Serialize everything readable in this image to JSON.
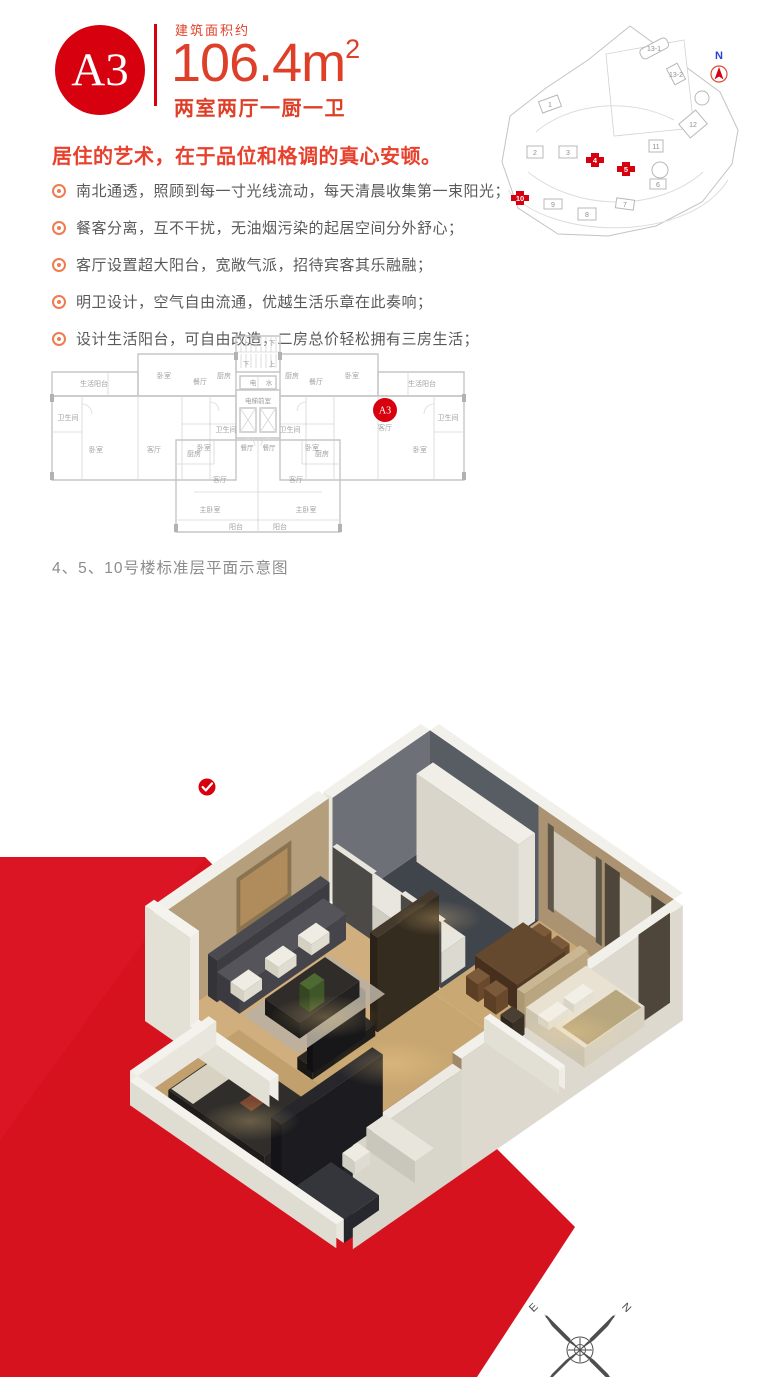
{
  "header": {
    "unit_badge": "A3",
    "area_label": "建筑面积约",
    "area_value": "106.4m",
    "area_sup": "2",
    "layout": "两室两厅一厨一卫"
  },
  "intro": {
    "headline": "居住的艺术，在于品位和格调的真心安顿。",
    "bullets": [
      "南北通透，照顾到每一寸光线流动，每天清晨收集第一束阳光；",
      "餐客分离，互不干扰，无油烟污染的起居空间分外舒心；",
      "客厅设置超大阳台，宽敞气派，招待宾客其乐融融；",
      "明卫设计，空气自由流通，优越生活乐章在此奏响；",
      "设计生活阳台，可自由改造，二房总价轻松拥有三房生活；"
    ]
  },
  "siteplan": {
    "north_label": "N",
    "buildings": [
      {
        "label": "1"
      },
      {
        "label": "2"
      },
      {
        "label": "3"
      },
      {
        "label": "6"
      },
      {
        "label": "7"
      },
      {
        "label": "8"
      },
      {
        "label": "9"
      },
      {
        "label": "11"
      },
      {
        "label": "12"
      },
      {
        "label": "13-1"
      },
      {
        "label": "13-2"
      }
    ],
    "highlighted": [
      {
        "label": "4"
      },
      {
        "label": "5"
      },
      {
        "label": "10"
      }
    ]
  },
  "floorplan": {
    "badge": "A3",
    "caption": "4、5、10号楼标准层平面示意图",
    "labels": [
      "生活阳台",
      "卧室",
      "餐厅",
      "厨房",
      "卫生间",
      "卧室",
      "客厅",
      "卧室",
      "卫生间",
      "上",
      "下",
      "下",
      "上",
      "电",
      "水",
      "电梯前室",
      "餐厅",
      "餐厅",
      "厨房",
      "客厅",
      "主卧室",
      "阳台",
      "阳台",
      "主卧室",
      "客厅",
      "厨房",
      "厨房",
      "餐厅",
      "卧室",
      "生活阳台",
      "卫生间",
      "卧室",
      "客厅",
      "卧室",
      "卫生间"
    ]
  },
  "compass": {
    "n": "N",
    "e": "E",
    "s": "S",
    "w": "W"
  },
  "colors": {
    "brand_red": "#d6000f",
    "backdrop_red": "#d7121f",
    "accent_orange": "#ee7c50",
    "text_red": "#dd3f28",
    "text_gray": "#595959"
  },
  "apartment": {
    "items": [
      {
        "k": "f",
        "u": 5,
        "v": 5,
        "du": 145,
        "dv": 130,
        "c": "#40444b"
      },
      {
        "k": "f",
        "u": 150,
        "v": 5,
        "du": 80,
        "dv": 140,
        "c": "#c9a873"
      },
      {
        "k": "f",
        "u": 230,
        "v": 5,
        "du": 100,
        "dv": 145,
        "c": "#cdab77"
      },
      {
        "k": "f",
        "u": 0,
        "v": 135,
        "du": 150,
        "dv": 215,
        "c": "#d0ae7d"
      },
      {
        "k": "f",
        "u": 150,
        "v": 145,
        "du": 80,
        "dv": 165,
        "c": "#c8a671"
      },
      {
        "k": "f",
        "u": 55,
        "v": 310,
        "du": 185,
        "dv": 135,
        "c": "#c2a06e"
      },
      {
        "k": "f",
        "u": 240,
        "v": 300,
        "du": 90,
        "dv": 145,
        "c": "#1a1b1f"
      },
      {
        "k": "w",
        "ax": "u",
        "c": 5,
        "a1": 5,
        "a2": 150,
        "h": 115,
        "t": -12,
        "face": "#585c63",
        "outer": null,
        "top": "#f2f0ea"
      },
      {
        "k": "w",
        "ax": "u",
        "c": 5,
        "a1": 150,
        "a2": 330,
        "h": 115,
        "t": -12,
        "face": "#ab9371",
        "outer": null,
        "top": "#f2f0ea"
      },
      {
        "k": "c",
        "pts": [
          [
            168,
            5,
            100
          ],
          [
            228,
            5,
            100
          ],
          [
            228,
            5,
            22
          ],
          [
            168,
            5,
            22
          ]
        ],
        "c": "#cfc8b8"
      },
      {
        "k": "c",
        "pts": [
          [
            162,
            5,
            104
          ],
          [
            170,
            5,
            104
          ],
          [
            170,
            5,
            18
          ],
          [
            162,
            5,
            18
          ]
        ],
        "c": "#5d5649"
      },
      {
        "k": "c",
        "pts": [
          [
            226,
            5,
            104
          ],
          [
            234,
            5,
            104
          ],
          [
            234,
            5,
            18
          ],
          [
            226,
            5,
            18
          ]
        ],
        "c": "#5d5649"
      },
      {
        "k": "c",
        "pts": [
          [
            238,
            5,
            104
          ],
          [
            258,
            5,
            104
          ],
          [
            258,
            5,
            14
          ],
          [
            238,
            5,
            14
          ]
        ],
        "c": "#4e463a"
      },
      {
        "k": "c",
        "pts": [
          [
            258,
            5,
            100
          ],
          [
            300,
            5,
            100
          ],
          [
            300,
            5,
            18
          ],
          [
            258,
            5,
            18
          ]
        ],
        "c": "#d5cfbf"
      },
      {
        "k": "c",
        "pts": [
          [
            300,
            5,
            104
          ],
          [
            324,
            5,
            104
          ],
          [
            324,
            5,
            14
          ],
          [
            300,
            5,
            14
          ]
        ],
        "c": "#4e463a"
      },
      {
        "k": "w",
        "ax": "v",
        "c": 5,
        "a1": 5,
        "a2": 135,
        "h": 115,
        "t": -12,
        "face": "#6d7077",
        "outer": "#e9e6dd",
        "top": "#f2f0ea"
      },
      {
        "k": "w",
        "ax": "v",
        "c": 0,
        "a1": 135,
        "a2": 350,
        "h": 112,
        "t": -14,
        "face": "#b59e7b",
        "outer": "#eae7de",
        "top": "#f2f0ea"
      },
      {
        "k": "c",
        "pts": [
          [
            0,
            185,
            96
          ],
          [
            0,
            258,
            96
          ],
          [
            0,
            258,
            40
          ],
          [
            0,
            185,
            40
          ]
        ],
        "c": "#8a7350"
      },
      {
        "k": "c",
        "pts": [
          [
            0,
            190,
            91
          ],
          [
            0,
            253,
            91
          ],
          [
            0,
            253,
            45
          ],
          [
            0,
            190,
            45
          ]
        ],
        "c": "#b08c5c"
      },
      {
        "k": "w",
        "ax": "v",
        "c": 330,
        "a1": 5,
        "a2": 300,
        "h": 115,
        "t": 12,
        "face": "#a08968",
        "outer": "#ddd9cf",
        "top": "#f2f0ea"
      },
      {
        "k": "c",
        "pts": [
          [
            330,
            10,
            104
          ],
          [
            330,
            52,
            104
          ],
          [
            330,
            52,
            14
          ],
          [
            330,
            10,
            14
          ]
        ],
        "c": "#4e463a"
      },
      {
        "k": "w",
        "ax": "v",
        "c": 330,
        "a1": 300,
        "a2": 445,
        "h": 104,
        "t": 12,
        "face": "#25272c",
        "outer": "#d8d5cb",
        "top": "#eceae3"
      },
      {
        "k": "b",
        "u": 12,
        "v": 8,
        "du": 136,
        "dv": 22,
        "h": 88,
        "ct": "#f0eee7",
        "cu": "#e4e1d8",
        "cv": "#d9d5ca"
      },
      {
        "k": "b",
        "u": 15,
        "v": 98,
        "du": 130,
        "dv": 32,
        "h": 30,
        "ct": "#e9e6df",
        "cu": "#dcd9d0",
        "cv": "#cfccc2"
      },
      {
        "k": "w",
        "ax": "u",
        "c": 135,
        "a1": 5,
        "a2": 58,
        "h": 66,
        "t": -6,
        "face": "#4b4a47",
        "outer": null,
        "top": "#e8e5dd"
      },
      {
        "k": "w",
        "ax": "u",
        "c": 135,
        "a1": 96,
        "a2": 150,
        "h": 66,
        "t": -6,
        "face": "#4b4a47",
        "outer": null,
        "top": "#e8e5dd"
      },
      {
        "k": "b",
        "u": 172,
        "v": 26,
        "du": 16,
        "dv": 16,
        "h": 20,
        "ct": "#7a5a3b",
        "cu": "#68492c",
        "cv": "#5c3f24"
      },
      {
        "k": "b",
        "u": 196,
        "v": 26,
        "du": 16,
        "dv": 16,
        "h": 20,
        "ct": "#7a5a3b",
        "cu": "#68492c",
        "cv": "#5c3f24"
      },
      {
        "k": "b",
        "u": 166,
        "v": 42,
        "du": 56,
        "dv": 64,
        "h": 26,
        "ct": "#64492f",
        "cu": "#523a24",
        "cv": "#46301d"
      },
      {
        "k": "b",
        "u": 172,
        "v": 108,
        "du": 16,
        "dv": 16,
        "h": 18,
        "ct": "#7a5a3b",
        "cu": "#68492c",
        "cv": "#5c3f24"
      },
      {
        "k": "b",
        "u": 196,
        "v": 108,
        "du": 16,
        "dv": 16,
        "h": 18,
        "ct": "#7a5a3b",
        "cu": "#68492c",
        "cv": "#5c3f24"
      },
      {
        "k": "b",
        "u": 234,
        "v": 34,
        "du": 10,
        "dv": 84,
        "h": 34,
        "ct": "#c9b692",
        "cu": "#b9a57f",
        "cv": "#ac9873"
      },
      {
        "k": "b",
        "u": 244,
        "v": 36,
        "du": 78,
        "dv": 80,
        "h": 20,
        "ct": "#e9e2d2",
        "cu": "#d9d1bf",
        "cv": "#cdc4b0"
      },
      {
        "k": "c",
        "pts": [
          [
            288,
            40,
            21
          ],
          [
            322,
            40,
            21
          ],
          [
            322,
            112,
            21
          ],
          [
            288,
            112,
            21
          ]
        ],
        "c": "#b8a67e"
      },
      {
        "k": "b",
        "u": 248,
        "v": 44,
        "du": 14,
        "dv": 26,
        "h": 8,
        "ct": "#f2efe6",
        "cu": "#e4e0d4",
        "cv": "#d8d4c6"
      },
      {
        "k": "b",
        "u": 248,
        "v": 78,
        "du": 14,
        "dv": 26,
        "h": 8,
        "ct": "#f2efe6",
        "cu": "#e4e0d4",
        "cv": "#d8d4c6"
      },
      {
        "k": "b",
        "u": 234,
        "v": 124,
        "du": 16,
        "dv": 16,
        "h": 20,
        "ct": "#4a3f33",
        "cu": "#3a3026",
        "cv": "#2f261d"
      },
      {
        "k": "b",
        "u": 140,
        "v": 138,
        "du": 10,
        "dv": 82,
        "h": 95,
        "ct": "#44392b",
        "cu": "#352c20",
        "cv": "#2b2318"
      },
      {
        "k": "b",
        "u": 132,
        "v": 225,
        "du": 20,
        "dv": 84,
        "h": 12,
        "ct": "#2a2723",
        "cu": "#201e1b",
        "cv": "#191815"
      },
      {
        "k": "b",
        "u": 138,
        "v": 232,
        "du": 8,
        "dv": 70,
        "h": 46,
        "ct": "#222226",
        "cu": "#17171a",
        "cv": "#101013"
      },
      {
        "k": "c",
        "pts": [
          [
            46,
            180,
            2
          ],
          [
            120,
            180,
            2
          ],
          [
            120,
            295,
            2
          ],
          [
            46,
            295,
            2
          ]
        ],
        "c": "#b9b2a3",
        "o": 0.88
      },
      {
        "k": "b",
        "u": 2,
        "v": 148,
        "du": 12,
        "dv": 150,
        "h": 42,
        "ct": "#4a4a50",
        "cu": "#3c3c42",
        "cv": "#333338"
      },
      {
        "k": "b",
        "u": 10,
        "v": 152,
        "du": 30,
        "dv": 142,
        "h": 26,
        "ct": "#54545a",
        "cu": "#44444a",
        "cv": "#3a3a40"
      },
      {
        "k": "b",
        "u": 14,
        "v": 166,
        "du": 18,
        "dv": 24,
        "h": 11,
        "ct": "#efece3",
        "cu": "#e0dcd0",
        "cv": "#d4d0c2"
      },
      {
        "k": "b",
        "u": 14,
        "v": 210,
        "du": 18,
        "dv": 24,
        "h": 11,
        "ct": "#efece3",
        "cu": "#e0dcd0",
        "cv": "#d4d0c2"
      },
      {
        "k": "b",
        "u": 14,
        "v": 256,
        "du": 18,
        "dv": 24,
        "h": 11,
        "ct": "#efece3",
        "cu": "#e0dcd0",
        "cv": "#d4d0c2"
      },
      {
        "k": "b",
        "u": 58,
        "v": 198,
        "du": 46,
        "dv": 80,
        "h": 16,
        "ct": "#2f2c29",
        "cu": "#242220",
        "cv": "#1c1b19"
      },
      {
        "k": "b",
        "u": 72,
        "v": 226,
        "du": 13,
        "dv": 20,
        "h": 22,
        "ct": "#4e6a33",
        "cu": "#3f5629",
        "cv": "#344721"
      },
      {
        "k": "w",
        "ax": "u",
        "c": 150,
        "a1": 230,
        "a2": 330,
        "h": 24,
        "t": 8,
        "face": "#efede6",
        "outer": "#e2dfd5",
        "top": "#f5f3ee"
      },
      {
        "k": "b",
        "u": 85,
        "v": 352,
        "du": 128,
        "dv": 82,
        "h": 20,
        "ct": "#302e2b",
        "cu": "#262422",
        "cv": "#1e1c1a"
      },
      {
        "k": "c",
        "pts": [
          [
            87,
            356,
            21
          ],
          [
            116,
            356,
            21
          ],
          [
            116,
            432,
            21
          ],
          [
            87,
            432,
            21
          ]
        ],
        "c": "#d8d2c2"
      },
      {
        "k": "c",
        "pts": [
          [
            146,
            382,
            21
          ],
          [
            162,
            382,
            21
          ],
          [
            162,
            400,
            21
          ],
          [
            146,
            400,
            21
          ]
        ],
        "c": "#7a4630"
      },
      {
        "k": "b",
        "u": 228,
        "v": 305,
        "du": 14,
        "dv": 135,
        "h": 70,
        "ct": "#26262b",
        "cu": "#1c1c20",
        "cv": "#141417"
      },
      {
        "k": "b",
        "u": 255,
        "v": 315,
        "du": 65,
        "dv": 25,
        "h": 22,
        "ct": "#e8e5dc",
        "cu": "#d8d5cb",
        "cv": "#c9c6bb"
      },
      {
        "k": "b",
        "u": 255,
        "v": 352,
        "du": 17,
        "dv": 20,
        "h": 13,
        "ct": "#eeebe3",
        "cu": "#dedbd2",
        "cv": "#d0cdc3"
      },
      {
        "k": "b",
        "u": 258,
        "v": 390,
        "du": 64,
        "dv": 46,
        "h": 15,
        "ct": "#34363c",
        "cu": "#26282d",
        "cv": "#1d1f23"
      },
      {
        "k": "w",
        "ax": "u",
        "c": 352,
        "a1": -16,
        "a2": 44,
        "h": 115,
        "t": 12,
        "face": "#efede6",
        "outer": "#e3e0d6",
        "top": "#f5f3ee"
      },
      {
        "k": "w",
        "ax": "u",
        "c": 352,
        "a1": 44,
        "a2": 150,
        "h": 26,
        "t": 12,
        "face": "#efede6",
        "outer": "#e2dfd5",
        "top": "#f5f3ee"
      },
      {
        "k": "w",
        "ax": "v",
        "c": 55,
        "a1": 340,
        "a2": 445,
        "h": 24,
        "t": -10,
        "face": "#e9e6dd",
        "outer": "#eeebe2",
        "top": "#f4f2ec"
      },
      {
        "k": "w",
        "ax": "u",
        "c": 445,
        "a1": 55,
        "a2": 330,
        "h": 24,
        "t": 10,
        "face": "#e9e6dd",
        "outer": "#dfdcd2",
        "top": "#f4f2ec"
      }
    ]
  }
}
